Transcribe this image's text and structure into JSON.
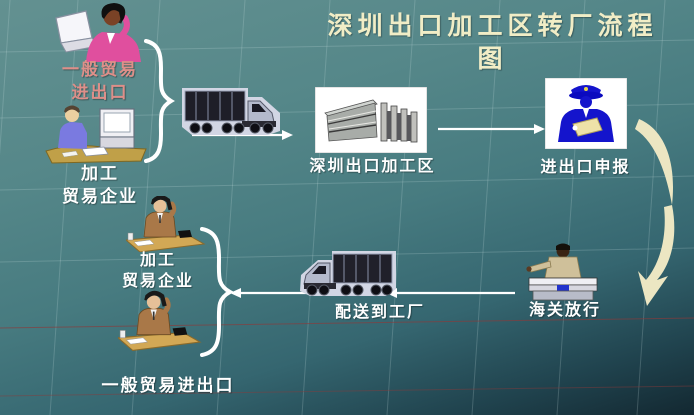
{
  "slide": {
    "title_line1": "深圳出口加工区转厂流程",
    "title_line2": "图"
  },
  "labels": {
    "general_trade_top_line1": "一般贸易",
    "general_trade_top_line2": "进出口",
    "processing_top_line1": "加工",
    "processing_top_line2": "贸易企业",
    "epz": "深圳出口加工区",
    "declaration": "进出口申报",
    "customs_release": "海关放行",
    "delivery": "配送到工厂",
    "processing_bottom_line1": "加工",
    "processing_bottom_line2": "贸易企业",
    "general_trade_bottom": "一般贸易进出口"
  },
  "colors": {
    "title_text": "#f1edc6",
    "label_white": "#ffffff",
    "label_rose": "#de8f89",
    "swoosh_yellow": "#ece6c2",
    "officer_blue": "#1414cc",
    "arrow_white": "#ffffff",
    "bg_top": "#5f8e8e",
    "bg_bottom": "#16282e",
    "red_gridline": "#8c3a3a"
  },
  "icons": {
    "woman_with_laptop": "businesswoman-phone-laptop",
    "man_at_computer": "clerk-at-computer",
    "truck_outbound": "truck-facing-right",
    "epz_building": "factory-building-photo",
    "customs_declaration_officer": "customs-officer-with-document",
    "curved_arrow": "curved-down-arrow",
    "customs_release_officer": "customs-officer-at-counter",
    "truck_inbound": "truck-facing-left",
    "factory_worker_phone": "man-on-phone-at-desk",
    "brace": "curly-brace"
  }
}
